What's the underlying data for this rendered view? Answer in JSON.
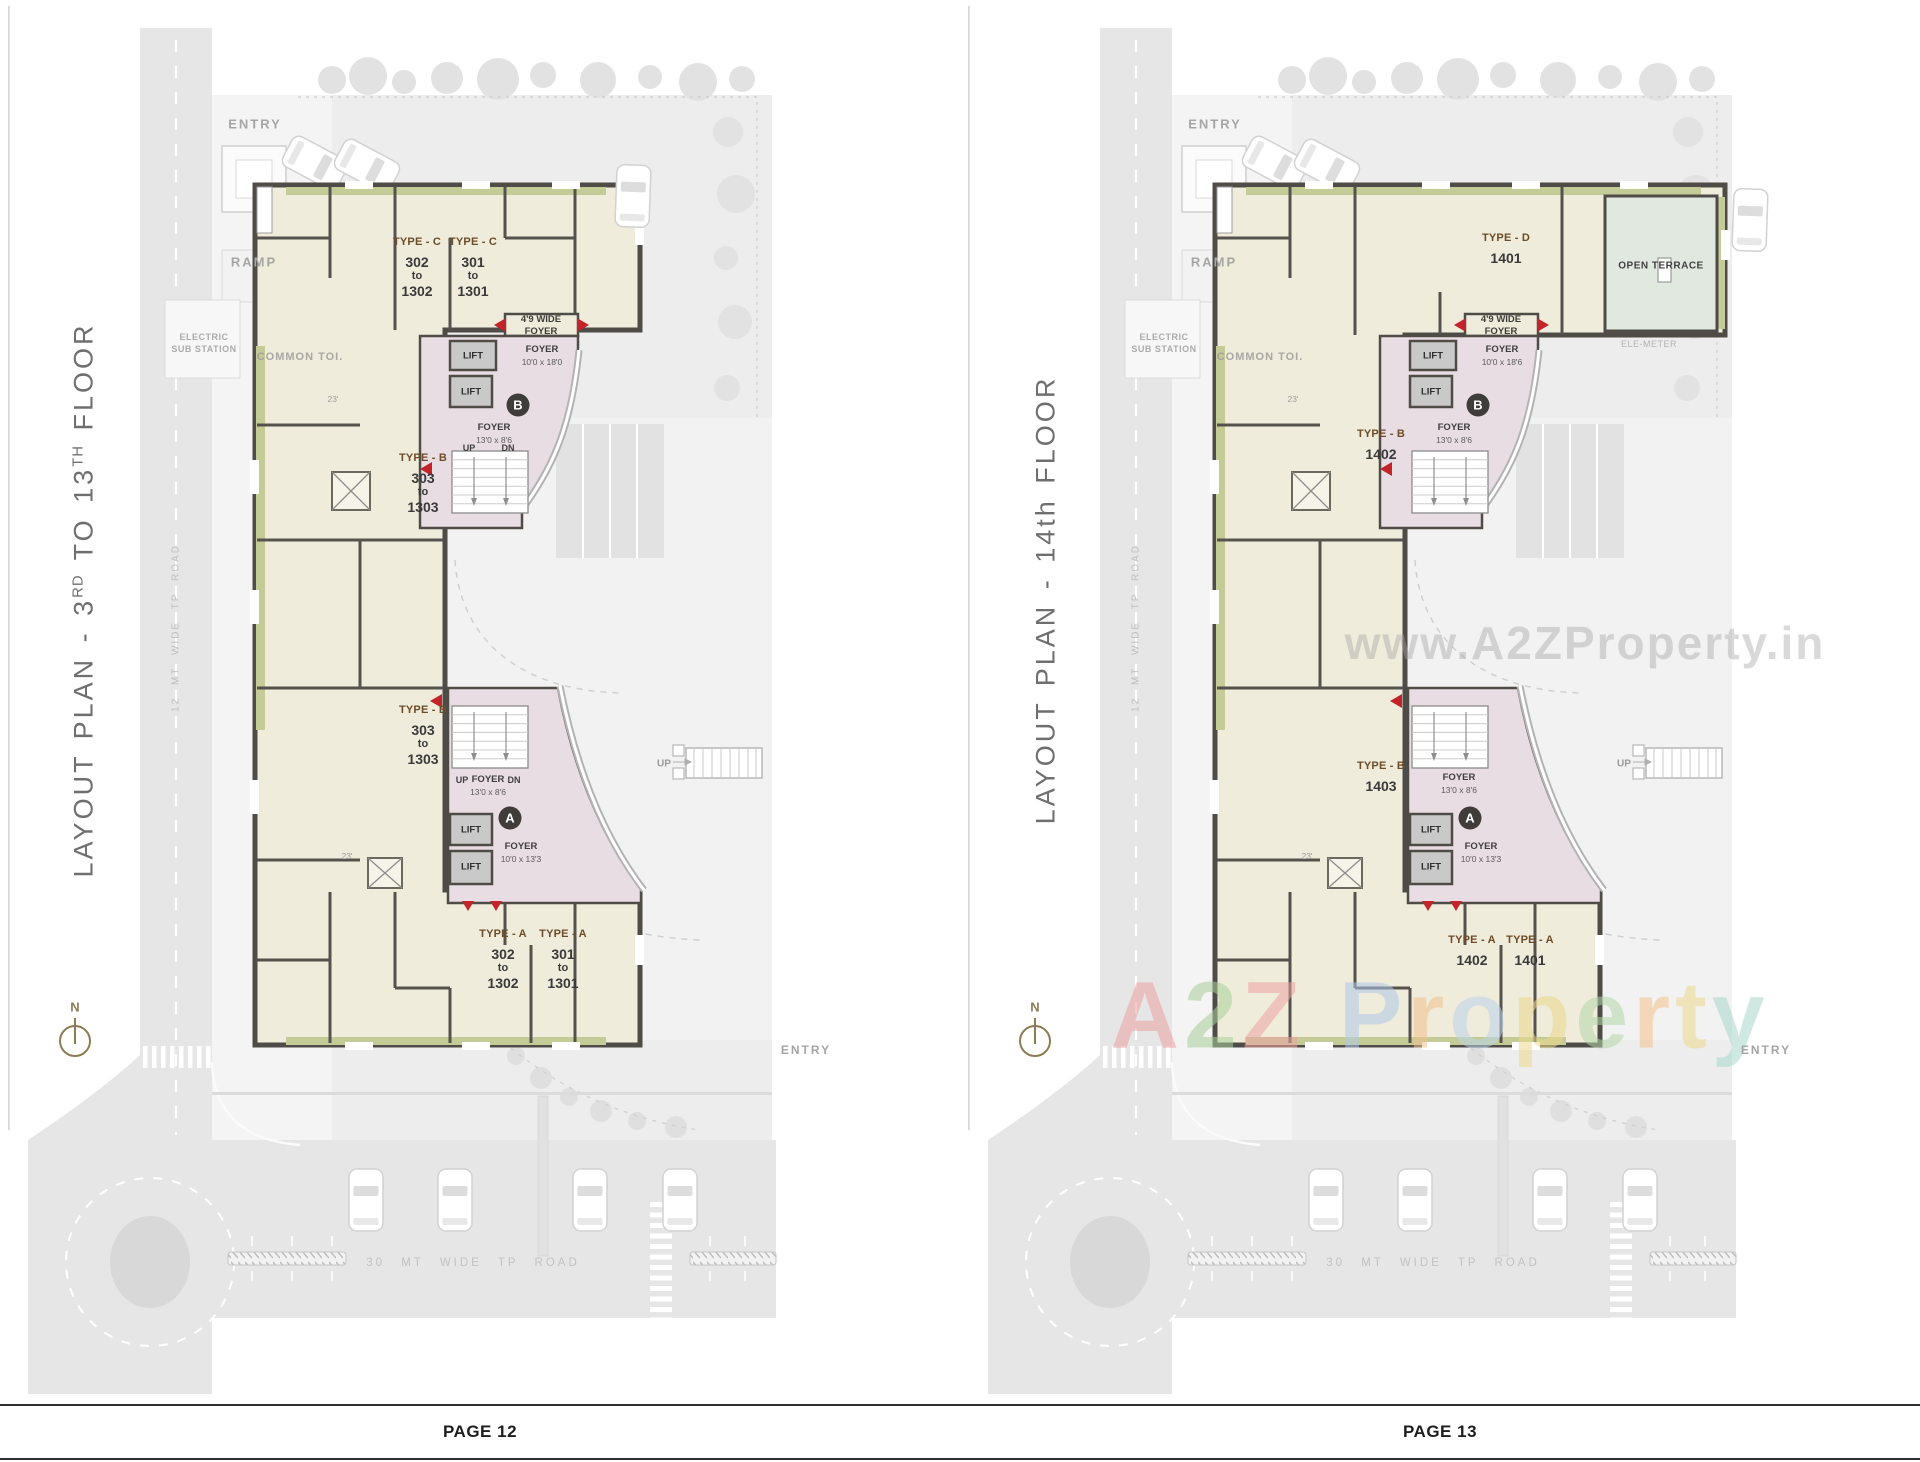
{
  "pages": [
    {
      "title": {
        "t1": "LAYOUT PLAN - 3",
        "s1": "RD",
        "t2": "  TO  13",
        "s2": "TH",
        "t3": "  FLOOR"
      },
      "page_label": "PAGE 12",
      "site": {
        "entry_top": "ENTRY",
        "ramp": "RAMP",
        "electric_line1": "ELECTRIC",
        "electric_line2": "SUB STATION",
        "common_toilet": "COMMON TOI.",
        "dim_a": "23'",
        "dim_b": "23'",
        "entry_bottom": "ENTRY",
        "up_parking": "UP",
        "north": "N",
        "road_side": "12 MT  WIDE  TP  ROAD",
        "road_bottom": "30 MT   WIDE   TP   ROAD"
      },
      "units": {
        "top_left": {
          "type": "TYPE - C",
          "n1": "302",
          "to": "to",
          "n2": "1302"
        },
        "top_right": {
          "type": "TYPE - C",
          "n1": "301",
          "to": "to",
          "n2": "1301"
        },
        "mid_upper": {
          "type": "TYPE - B",
          "n1": "303",
          "to": "to",
          "n2": "1303"
        },
        "mid_lower": {
          "type": "TYPE - B",
          "n1": "303",
          "to": "to",
          "n2": "1303"
        },
        "bottom_left": {
          "type": "TYPE - A",
          "n1": "302",
          "to": "to",
          "n2": "1302"
        },
        "bottom_right": {
          "type": "TYPE - A",
          "n1": "301",
          "to": "to",
          "n2": "1301"
        }
      },
      "core": {
        "wide_foyer_line1": "4'9 WIDE",
        "wide_foyer_line2": "FOYER",
        "foyer_b_label": "FOYER",
        "foyer_b_size": "10'0 x 18'0",
        "badge_b": "B",
        "stair_b_label": "FOYER",
        "stair_b_size": "13'0 x 8'6",
        "up": "UP",
        "dn": "DN",
        "stair_a_up": "UP",
        "stair_a_label": "FOYER",
        "stair_a_size": "13'0 x 8'6",
        "stair_a_dn": "DN",
        "badge_a": "A",
        "foyer_a_label": "FOYER",
        "foyer_a_size": "10'0 x 13'3",
        "lift": "LIFT"
      }
    },
    {
      "title": {
        "t1": "LAYOUT PLAN - 14th FLOOR"
      },
      "page_label": "PAGE 13",
      "site": {
        "entry_top": "ENTRY",
        "ramp": "RAMP",
        "electric_line1": "ELECTRIC",
        "electric_line2": "SUB STATION",
        "common_toilet": "COMMON TOI.",
        "dim_a": "23'",
        "dim_b": "23'",
        "open_terrace": "OPEN TERRACE",
        "ele_meter": "ELE-METER",
        "entry_bottom": "ENTRY",
        "up_parking": "UP",
        "north": "N",
        "road_side": "12 MT  WIDE  TP  ROAD",
        "road_bottom": "30 MT   WIDE   TP   ROAD"
      },
      "units": {
        "top": {
          "type": "TYPE - D",
          "n1": "1401"
        },
        "mid_upper": {
          "type": "TYPE - B",
          "n1": "1402"
        },
        "mid_lower": {
          "type": "TYPE - B",
          "n1": "1403"
        },
        "bottom_left": {
          "type": "TYPE - A",
          "n1": "1402"
        },
        "bottom_right": {
          "type": "TYPE - A",
          "n1": "1401"
        }
      },
      "core": {
        "wide_foyer_line1": "4'9 WIDE",
        "wide_foyer_line2": "FOYER",
        "foyer_b_label": "FOYER",
        "foyer_b_size": "10'0 x 18'6",
        "badge_b": "B",
        "stair_b_label": "FOYER",
        "stair_b_size": "13'0 x 8'6",
        "stair_a_label": "FOYER",
        "stair_a_size": "13'0 x 8'6",
        "badge_a": "A",
        "foyer_a_label": "FOYER",
        "foyer_a_size": "10'0 x 13'3",
        "lift": "LIFT"
      },
      "watermarks": {
        "url_text": "www.A2ZProperty.in",
        "brand": [
          {
            "ch": "A",
            "color": "#eda2a2"
          },
          {
            "ch": "2",
            "color": "#a9cf9b"
          },
          {
            "ch": "Z",
            "color": "#eda2a2"
          },
          {
            "ch": "P",
            "color": "#afc9e8"
          },
          {
            "ch": "r",
            "color": "#f2c18c"
          },
          {
            "ch": "o",
            "color": "#bcd4ec"
          },
          {
            "ch": "p",
            "color": "#ecd88c"
          },
          {
            "ch": "e",
            "color": "#b4d7a9"
          },
          {
            "ch": "r",
            "color": "#f2c18c"
          },
          {
            "ch": "t",
            "color": "#ecd88c"
          },
          {
            "ch": "y",
            "color": "#a8d8cb"
          }
        ]
      }
    }
  ]
}
